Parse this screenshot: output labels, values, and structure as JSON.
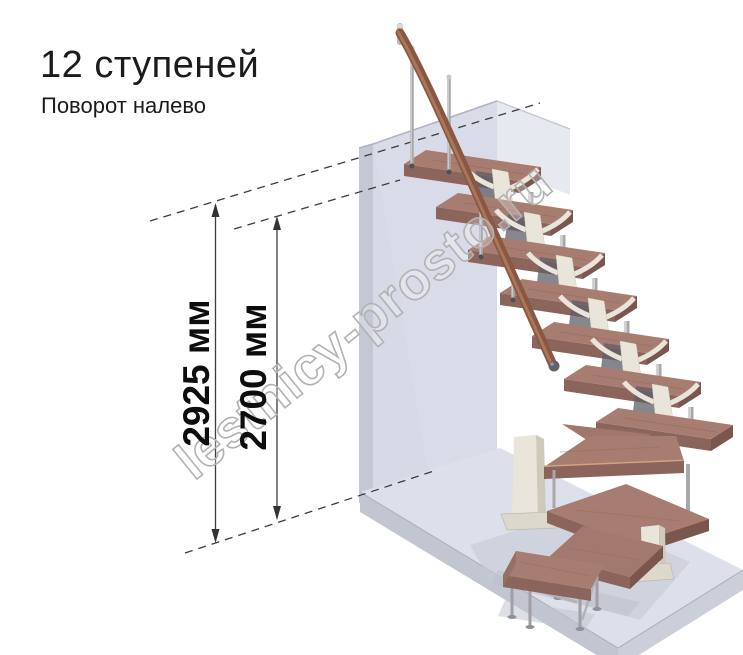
{
  "title": "12 ступеней",
  "subtitle": "Поворот налево",
  "watermark": "lestnicy-prosto.ru",
  "dimensions": [
    {
      "label": "2925 мм",
      "value_mm": 2925
    },
    {
      "label": "2700 мм",
      "value_mm": 2700
    }
  ],
  "diagram": {
    "type": "modular-staircase-isometric",
    "steps_total": 12,
    "turn_direction": "left",
    "composition": {
      "straight_treads": 7,
      "winder_treads": 4,
      "bottom_steps": 1
    },
    "colors": {
      "tread_top": "#a87d71",
      "tread_front": "#8b655c",
      "tread_side": "#7b564e",
      "winder_trim": "#d0a37c",
      "stringer_cream": "#e9e5da",
      "metal": "#a8a8ac",
      "handrail_wood": "#8a5742",
      "wall": "#d6d9e6",
      "floor": "#dce0ea",
      "dimension_lines": "#3c3c3c",
      "watermark_stroke": "#b2b2b2"
    }
  }
}
